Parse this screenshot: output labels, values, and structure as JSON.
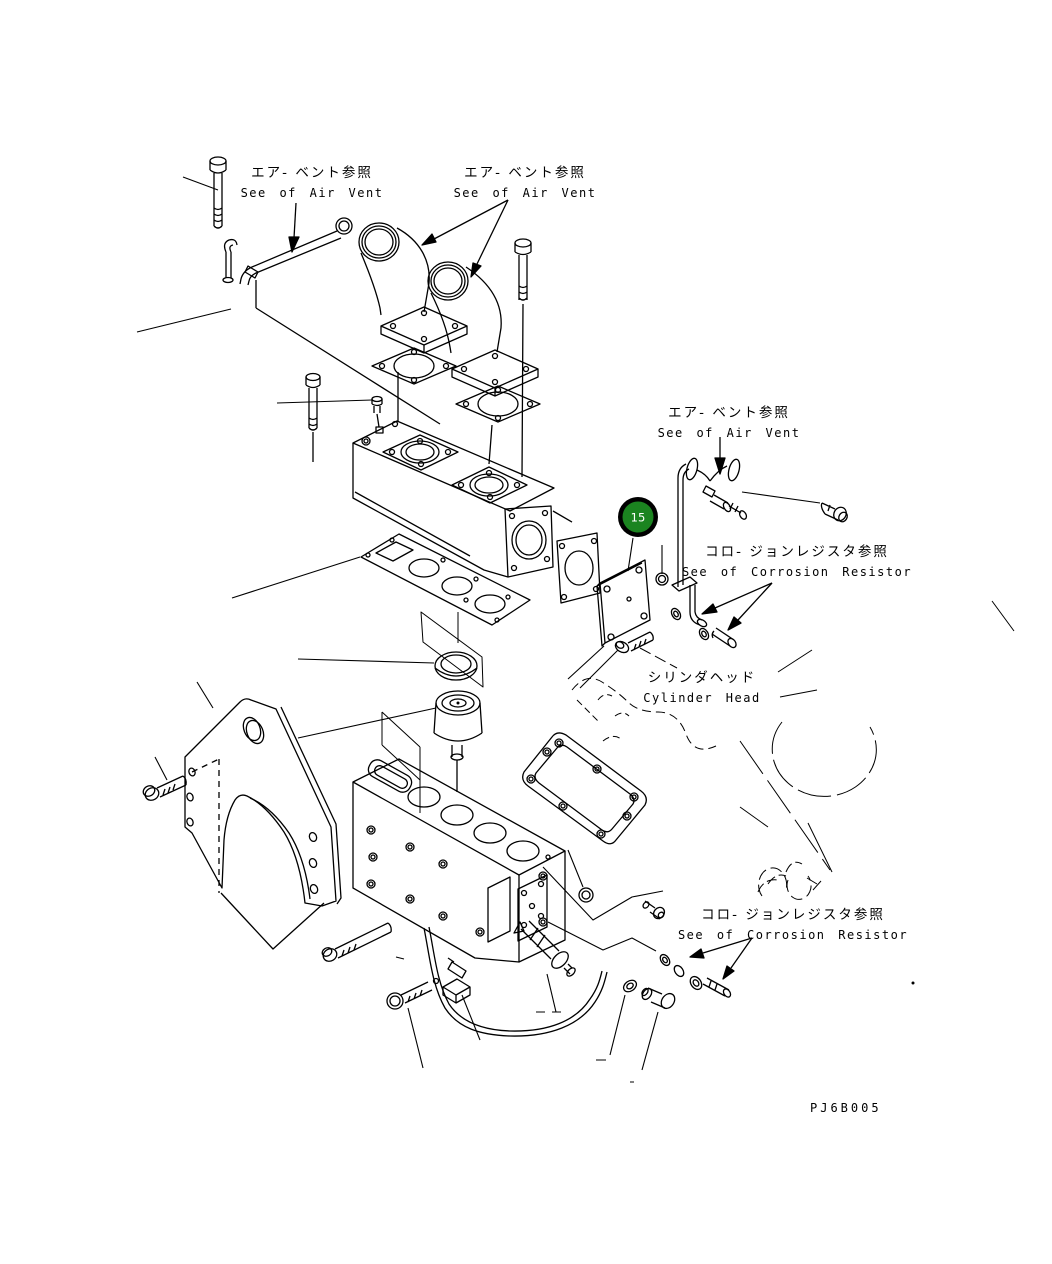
{
  "figure": {
    "drawing_code": "PJ6B005",
    "callout": {
      "number": "15",
      "fill": "#1b8420",
      "ring": "#000000",
      "text_color": "#ffffff"
    },
    "labels": {
      "air_vent_top_left": {
        "jp": "エア- ベント参照",
        "en": "See of Air Vent"
      },
      "air_vent_top_center": {
        "jp": "エア- ベント参照",
        "en": "See of Air Vent"
      },
      "air_vent_right": {
        "jp": "エア- ベント参照",
        "en": "See of Air Vent"
      },
      "corrosion_resistor_upper": {
        "jp": "コロ- ジョンレジスタ参照",
        "en": "See of Corrosion Resistor"
      },
      "cylinder_head": {
        "jp": "シリンダヘッド",
        "en": "Cylinder Head"
      },
      "corrosion_resistor_lower": {
        "jp": "コロ- ジョンレジスタ参照",
        "en": "See of Corrosion Resistor"
      }
    },
    "colors": {
      "line": "#000000",
      "background": "#ffffff"
    }
  }
}
